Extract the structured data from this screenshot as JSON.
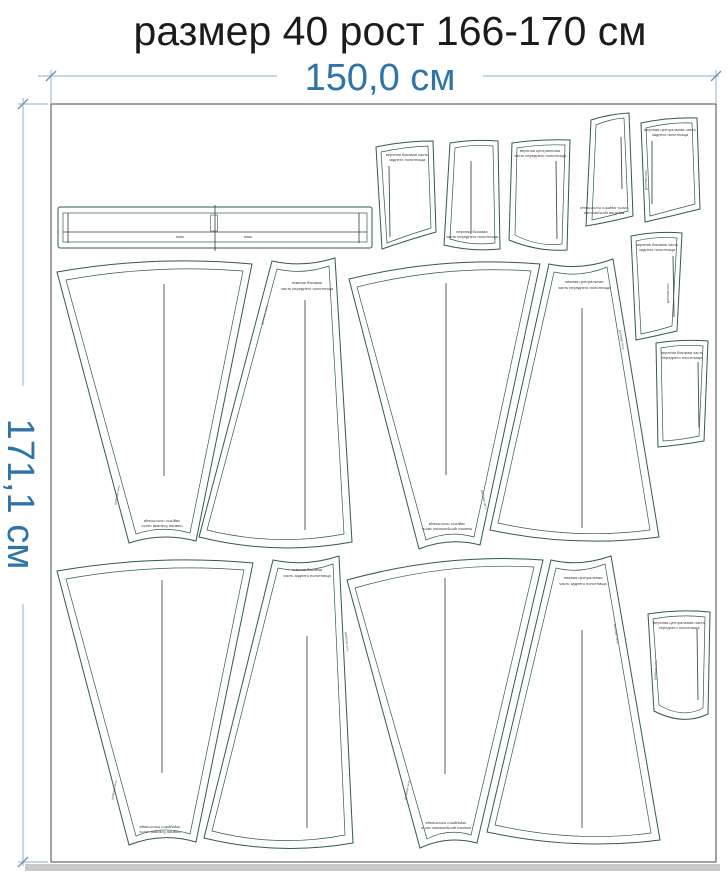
{
  "title": "размер 40 рост 166-170 см",
  "dimensions": {
    "width_label": "150,0 см",
    "height_label": "171,1 см"
  },
  "colors": {
    "piece_outline": "#2e5c50",
    "dimension_text": "#2e74a8",
    "dimension_line": "#a3bed3",
    "title_text": "#1b1b1b",
    "fabric_border": "#4a4a4a",
    "shadow": "#c9c9c9"
  },
  "pieces": {
    "waistband": {
      "label_left": "пояс",
      "label_right": "пояс"
    },
    "grain_label": "долевая нить",
    "gores": [
      {
        "id": "gore-1",
        "line1": "нижняя боковая часть",
        "line2": "заднего полотнища"
      },
      {
        "id": "gore-2",
        "line1": "нижняя боковая",
        "line2": "часть переднего полотнища"
      },
      {
        "id": "gore-3",
        "line1": "нижняя центральная часть",
        "line2": "заднего полотнища"
      },
      {
        "id": "gore-4",
        "line1": "нижняя центральная",
        "line2": "часть переднего полотнища"
      },
      {
        "id": "gore-5",
        "line1": "нижняя боковая часть",
        "line2": "переднего полотнища"
      },
      {
        "id": "gore-6",
        "line1": "нижняя боковая",
        "line2": "часть заднего полотнища"
      },
      {
        "id": "gore-7",
        "line1": "нижняя центральная часть",
        "line2": "переднего полотнища"
      },
      {
        "id": "gore-8",
        "line1": "нижняя центральная",
        "line2": "часть заднего полотнища"
      }
    ],
    "small": [
      {
        "id": "piece-a",
        "line1": "верхняя боковая часть",
        "line2": "заднего полотнища"
      },
      {
        "id": "piece-b",
        "line1": "верхняя боковая",
        "line2": "часть переднего полотнища"
      },
      {
        "id": "piece-c",
        "line1": "верхняя центральная",
        "line2": "часть переднего полотнища"
      },
      {
        "id": "piece-d",
        "line1": "верхняя центральная",
        "line2": "часть заднего полотнища"
      },
      {
        "id": "piece-e",
        "line1": "верхняя центральная часть",
        "line2": "заднего полотнища"
      },
      {
        "id": "piece-f",
        "line1": "верхняя боковая часть",
        "line2": "заднего полотнища"
      },
      {
        "id": "piece-g",
        "line1": "верхняя боковая часть",
        "line2": "переднего полотнища"
      },
      {
        "id": "piece-h",
        "line1": "верхняя центральная часть",
        "line2": "переднего полотнища"
      }
    ]
  }
}
